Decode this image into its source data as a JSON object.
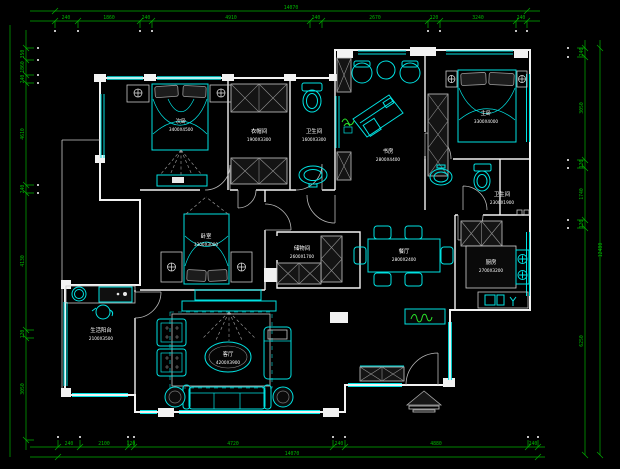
{
  "colors": {
    "background": "#000000",
    "walls": "#f2f2f2",
    "furniture": "#00e2e2",
    "dimensions": "#00b300",
    "room_labels": "#ffffff",
    "plants": "#2be32b"
  },
  "dims": {
    "top": {
      "total": "14070",
      "labels": [
        "240",
        "1860",
        "240",
        "4910",
        "240",
        "2670",
        "120",
        "3240",
        "240"
      ]
    },
    "bottom": {
      "total": "14070",
      "labels": [
        "240",
        "2100",
        "120",
        "4720",
        "240",
        "4880",
        "240"
      ]
    },
    "left": {
      "labels": [
        "350",
        "1860",
        "240",
        "4610",
        "240",
        "4130",
        "120",
        "3050"
      ]
    },
    "right": {
      "total": "12480",
      "labels": [
        "240",
        "3050",
        "120",
        "1740",
        "120",
        "6250"
      ]
    }
  },
  "rooms": {
    "bedroom_north": {
      "name": "次卧",
      "size": "3400X4500"
    },
    "cloakroom": {
      "name": "衣帽间",
      "size": "1900X3300"
    },
    "bath_main": {
      "name": "卫生间",
      "size": "1600X3300"
    },
    "study": {
      "name": "书房",
      "size": "2800X4400"
    },
    "master_bedroom": {
      "name": "主卧",
      "size": "3300X4000"
    },
    "bath_guest": {
      "name": "卫生间",
      "size": "2300X1900"
    },
    "bedroom_center": {
      "name": "卧室",
      "size": "3300X3000"
    },
    "storage": {
      "name": "储物间",
      "size": "2600X1700"
    },
    "dining": {
      "name": "餐厅",
      "size": "2800X2400"
    },
    "kitchen": {
      "name": "厨房",
      "size": "2700X3200"
    },
    "laundry_balcony": {
      "name": "生活阳台",
      "size": "2100X3500"
    },
    "living": {
      "name": "客厅",
      "size": "4200X3900"
    }
  }
}
